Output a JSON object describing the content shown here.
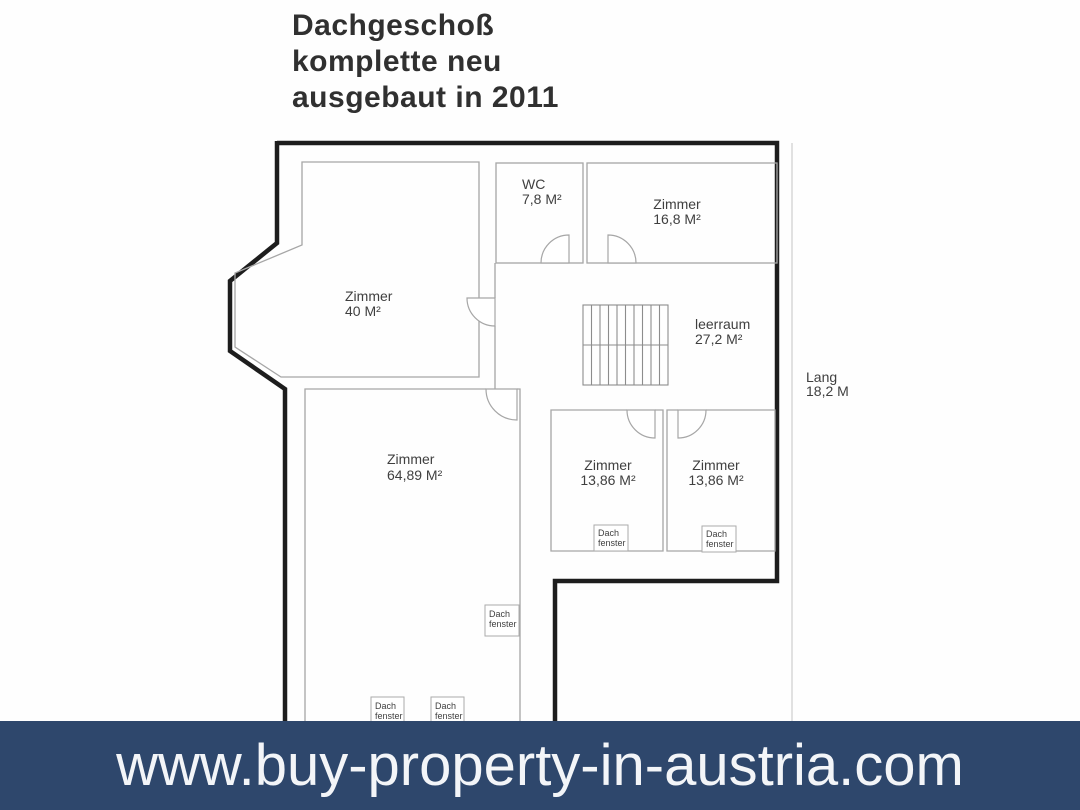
{
  "title": {
    "lines": [
      "Dachgeschoß",
      "komplette neu",
      "ausgebaut in 2011"
    ]
  },
  "floor_plan": {
    "rooms": [
      {
        "id": "wc",
        "name": "WC",
        "area": "7,8 M²"
      },
      {
        "id": "zimmer-16-8",
        "name": "Zimmer",
        "area": "16,8 M²"
      },
      {
        "id": "zimmer-40",
        "name": "Zimmer",
        "area": "40 M²"
      },
      {
        "id": "leerraum",
        "name": "leerraum",
        "area": "27,2 M²"
      },
      {
        "id": "zimmer-64-89",
        "name": "Zimmer",
        "area": "64,89 M²"
      },
      {
        "id": "zimmer-13-86-left",
        "name": "Zimmer",
        "area": "13,86 M²"
      },
      {
        "id": "zimmer-13-86-right",
        "name": "Zimmer",
        "area": "13,86 M²"
      }
    ],
    "dimension": {
      "label": "Lang",
      "value": "18,2 M"
    },
    "roof_window": {
      "line1": "Dach",
      "line2": "fenster"
    },
    "colors": {
      "wall": "#1d1d1d",
      "thin_line": "#a6a6a6",
      "label_text": "#3f3f3f"
    }
  },
  "banner": {
    "url": "www.buy-property-in-austria.com",
    "background": "#2e476c",
    "text_color": "#f3f5f8"
  }
}
